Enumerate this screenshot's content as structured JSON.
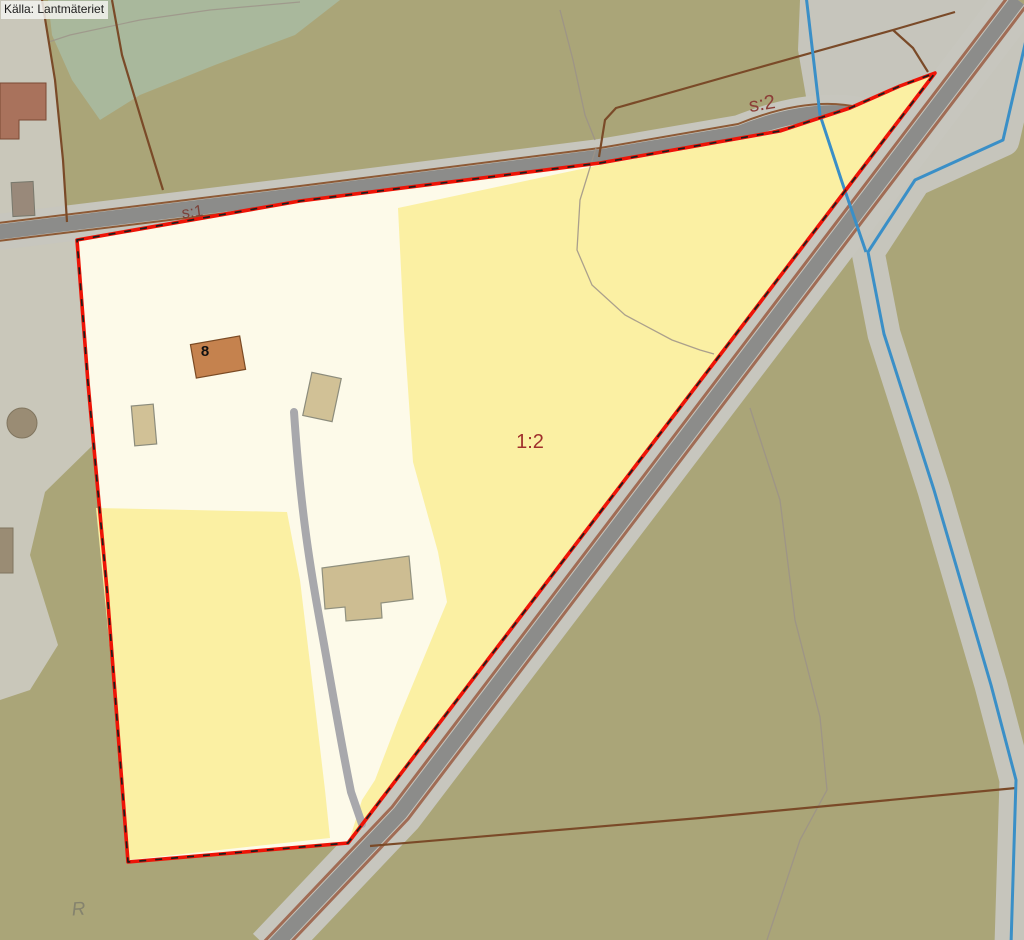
{
  "attribution": "Källa: Lantmäteriet",
  "map": {
    "labels": {
      "common_land_1": "s:1",
      "common_land_2": "s:2",
      "parcel_designation": "1:2",
      "building_number": "8",
      "ancient_monument_symbol": "R"
    },
    "colors": {
      "background_olive": "#aaa578",
      "urban_gray": "#c9c7ba",
      "forest_teal": "#a9b89c",
      "parcel_cream": "#fdfae9",
      "field_yellow": "#fbf0a3",
      "road_light": "#c7c6be",
      "road_dark": "#8c8c8a",
      "road_edge_brown": "#8d5a36",
      "diag_road_edge": "#a06c55",
      "cadastral_brown": "#7a4a28",
      "boundary_red": "#ee1407",
      "water_blue": "#3a8fc7",
      "contour_gray": "#9c9288",
      "track_gray": "#a8a8ac",
      "label_red": "#a0302c",
      "label_brown": "#81413a",
      "building_orange": "#c5824e",
      "building_beige": "#d1c196",
      "building_tan": "#cdbd92",
      "building_brown": "#a9725c",
      "building_gray": "#9a8c74"
    }
  }
}
